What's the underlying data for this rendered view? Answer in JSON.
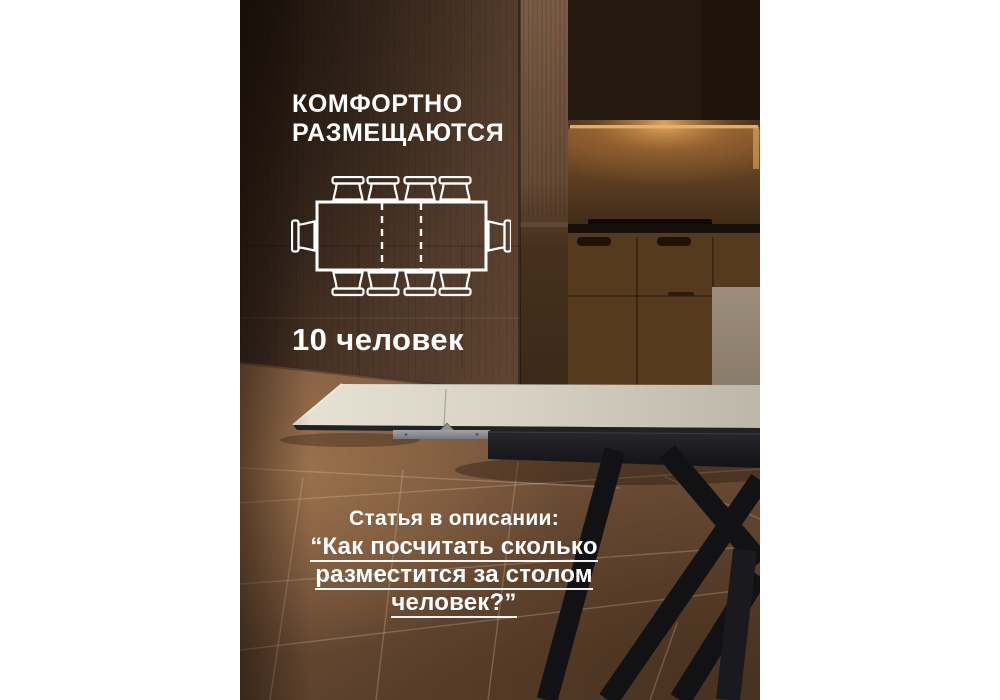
{
  "image_type": "product-infographic",
  "language": "ru",
  "headline": {
    "line1": "КОМФОРТНО",
    "line2": "РАЗМЕЩАЮТСЯ"
  },
  "capacity": {
    "label": "10 человек",
    "count": 10
  },
  "diagram": {
    "icon": "table-seating-top-view-icon",
    "chairs_total": 10,
    "chairs_top": 4,
    "chairs_bottom": 4,
    "chairs_left": 1,
    "chairs_right": 1,
    "extension_leaf_dashed_lines": 2
  },
  "footer": {
    "intro": "Статья в описании:",
    "quote_line1": "“Как посчитать сколько",
    "quote_line2": "разместится за столом",
    "quote_line3": "человек?”"
  },
  "colors": {
    "page_margins": "#ffffff",
    "text": "#ffffff",
    "wall_brown": "#4a3527",
    "wall_dark_corner": "#2c1f16",
    "floor_brown": "#6f5038",
    "floor_highlight": "#96704e",
    "under_cabinet_glow": "#e0a95e",
    "tabletop_ceramic": "#dcd8ca",
    "table_frame_black": "#17171a",
    "bracket_metal": "#95959a"
  }
}
